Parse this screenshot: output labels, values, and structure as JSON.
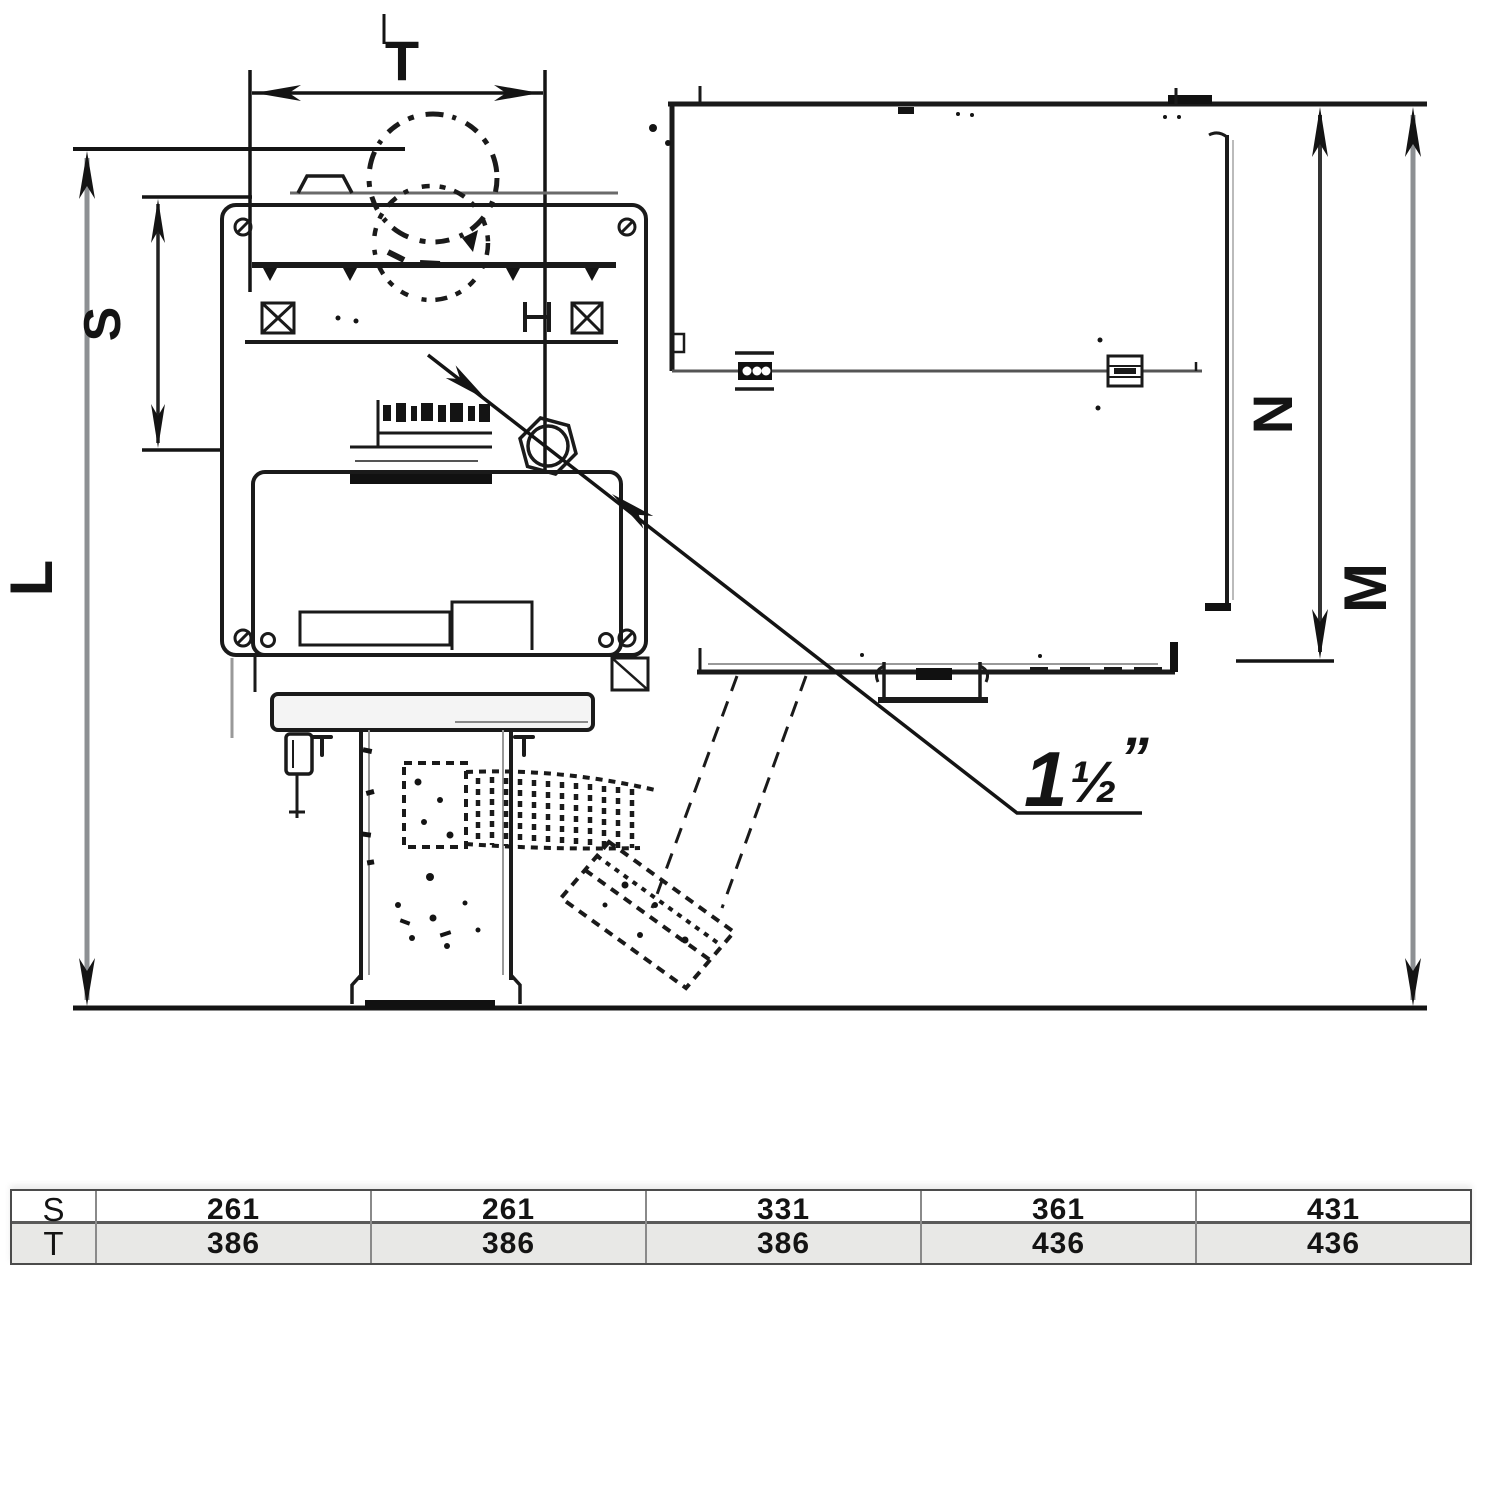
{
  "diagram": {
    "dim_labels": {
      "t": "T",
      "s": "S",
      "l": "L",
      "n": "N",
      "m": "M"
    },
    "connection": {
      "whole": "1",
      "fraction": "½",
      "unit": "”"
    }
  },
  "table": {
    "row_s": {
      "label": "S",
      "values": [
        "261",
        "261",
        "331",
        "361",
        "431"
      ]
    },
    "row_t": {
      "label": "T",
      "values": [
        "386",
        "386",
        "386",
        "436",
        "436"
      ]
    }
  },
  "colors": {
    "line": "#141414",
    "gray_line": "#8d9093",
    "row_t_bg": "#e8e8e6"
  }
}
